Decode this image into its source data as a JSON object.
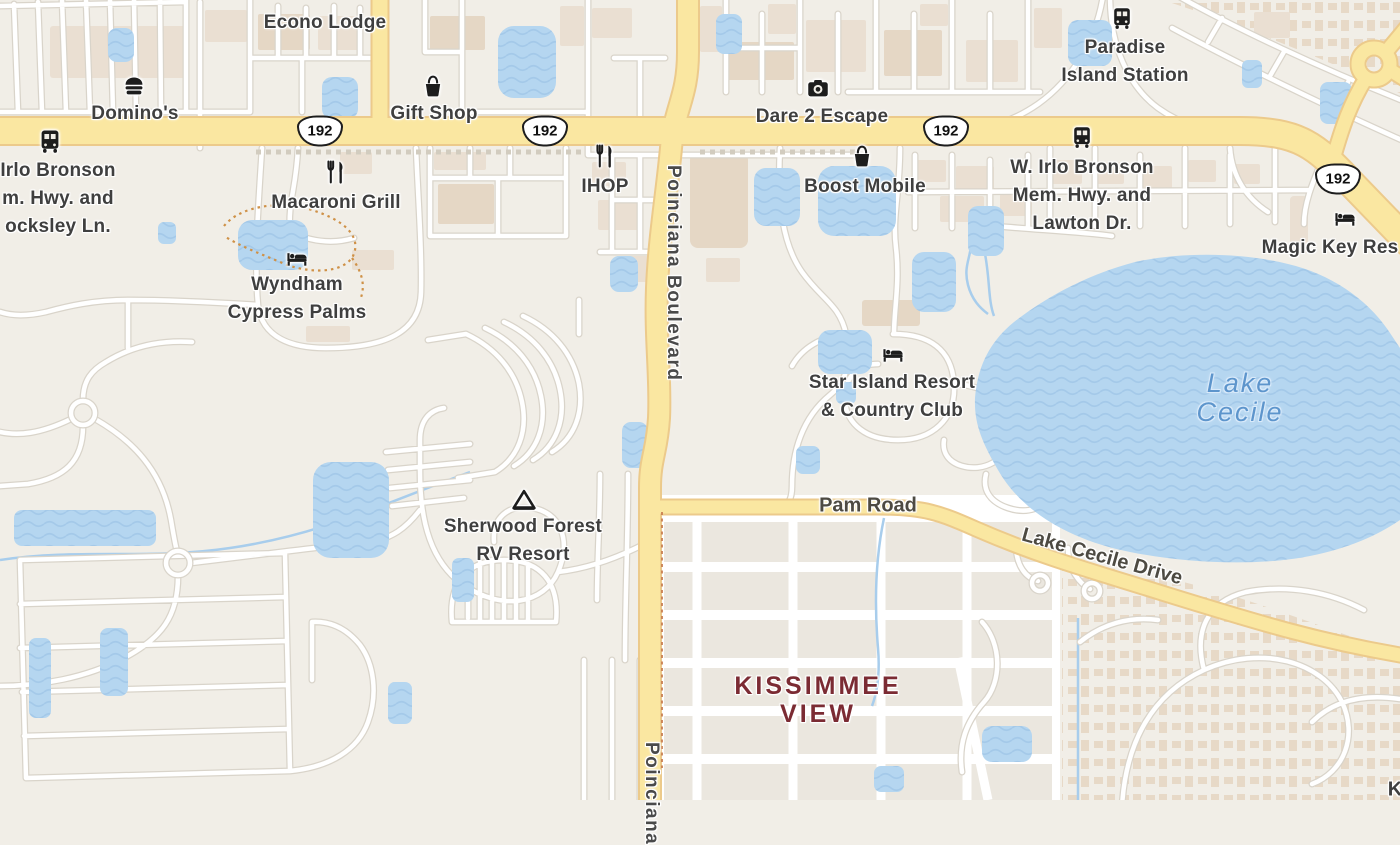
{
  "colors": {
    "land": "#f1eee7",
    "water": "#b5d6f0",
    "water_wave": "#a4c9e9",
    "road_minor_fill": "#ffffff",
    "road_minor_casing": "#d9d4ca",
    "road_major_fill": "#fae7a1",
    "road_major_casing": "#ecca8b",
    "building": "#eadfd2",
    "building_alt": "#e5d7c5",
    "poi_text": "#3f3f3f",
    "water_text": "#5d95cc",
    "area_text": "#7b2b33"
  },
  "roads": {
    "shield": "192",
    "poinciana": "Poinciana Boulevard",
    "poinciana_south": "Poinciana",
    "pam": "Pam Road",
    "lake_cecile_drive": "Lake Cecile Drive"
  },
  "pois": [
    {
      "id": "econo-lodge",
      "icon": null,
      "lines": [
        "Econo Lodge"
      ]
    },
    {
      "id": "dominos",
      "icon": "burger",
      "lines": [
        "Domino's"
      ]
    },
    {
      "id": "gift-shop",
      "icon": "shopping-basket",
      "lines": [
        "Gift Shop"
      ]
    },
    {
      "id": "dare-2-escape",
      "icon": "camera",
      "lines": [
        "Dare 2 Escape"
      ]
    },
    {
      "id": "paradise-island-station",
      "icon": "bus",
      "lines": [
        "Paradise",
        "Island Station"
      ]
    },
    {
      "id": "irlo-bronson-locksley",
      "icon": "bus",
      "lines": [
        "Irlo Bronson",
        "m. Hwy. and",
        "ocksley Ln."
      ]
    },
    {
      "id": "macaroni-grill",
      "icon": "restaurant",
      "lines": [
        "Macaroni Grill"
      ]
    },
    {
      "id": "ihop",
      "icon": "restaurant",
      "lines": [
        "IHOP"
      ]
    },
    {
      "id": "boost-mobile",
      "icon": "shopping-basket",
      "lines": [
        "Boost Mobile"
      ]
    },
    {
      "id": "w-irlo-bronson-lawton",
      "icon": "bus",
      "lines": [
        "W. Irlo Bronson",
        "Mem. Hwy. and",
        "Lawton Dr."
      ]
    },
    {
      "id": "magic-key-resort",
      "icon": "bed",
      "lines": [
        "Magic Key Res"
      ]
    },
    {
      "id": "wyndham-cypress-palms",
      "icon": "bed",
      "lines": [
        "Wyndham",
        "Cypress Palms"
      ]
    },
    {
      "id": "star-island-resort",
      "icon": "bed",
      "lines": [
        "Star Island Resort",
        "& Country Club"
      ]
    },
    {
      "id": "sherwood-forest-rv",
      "icon": "tent",
      "lines": [
        "Sherwood Forest",
        "RV Resort"
      ]
    }
  ],
  "water_labels": {
    "lake_cecile": {
      "lines": [
        "Lake",
        "Cecile"
      ]
    }
  },
  "area_labels": {
    "kissimmee_view": {
      "lines": [
        "KISSIMMEE",
        "VIEW"
      ]
    },
    "bottom_right_partial": "K"
  }
}
